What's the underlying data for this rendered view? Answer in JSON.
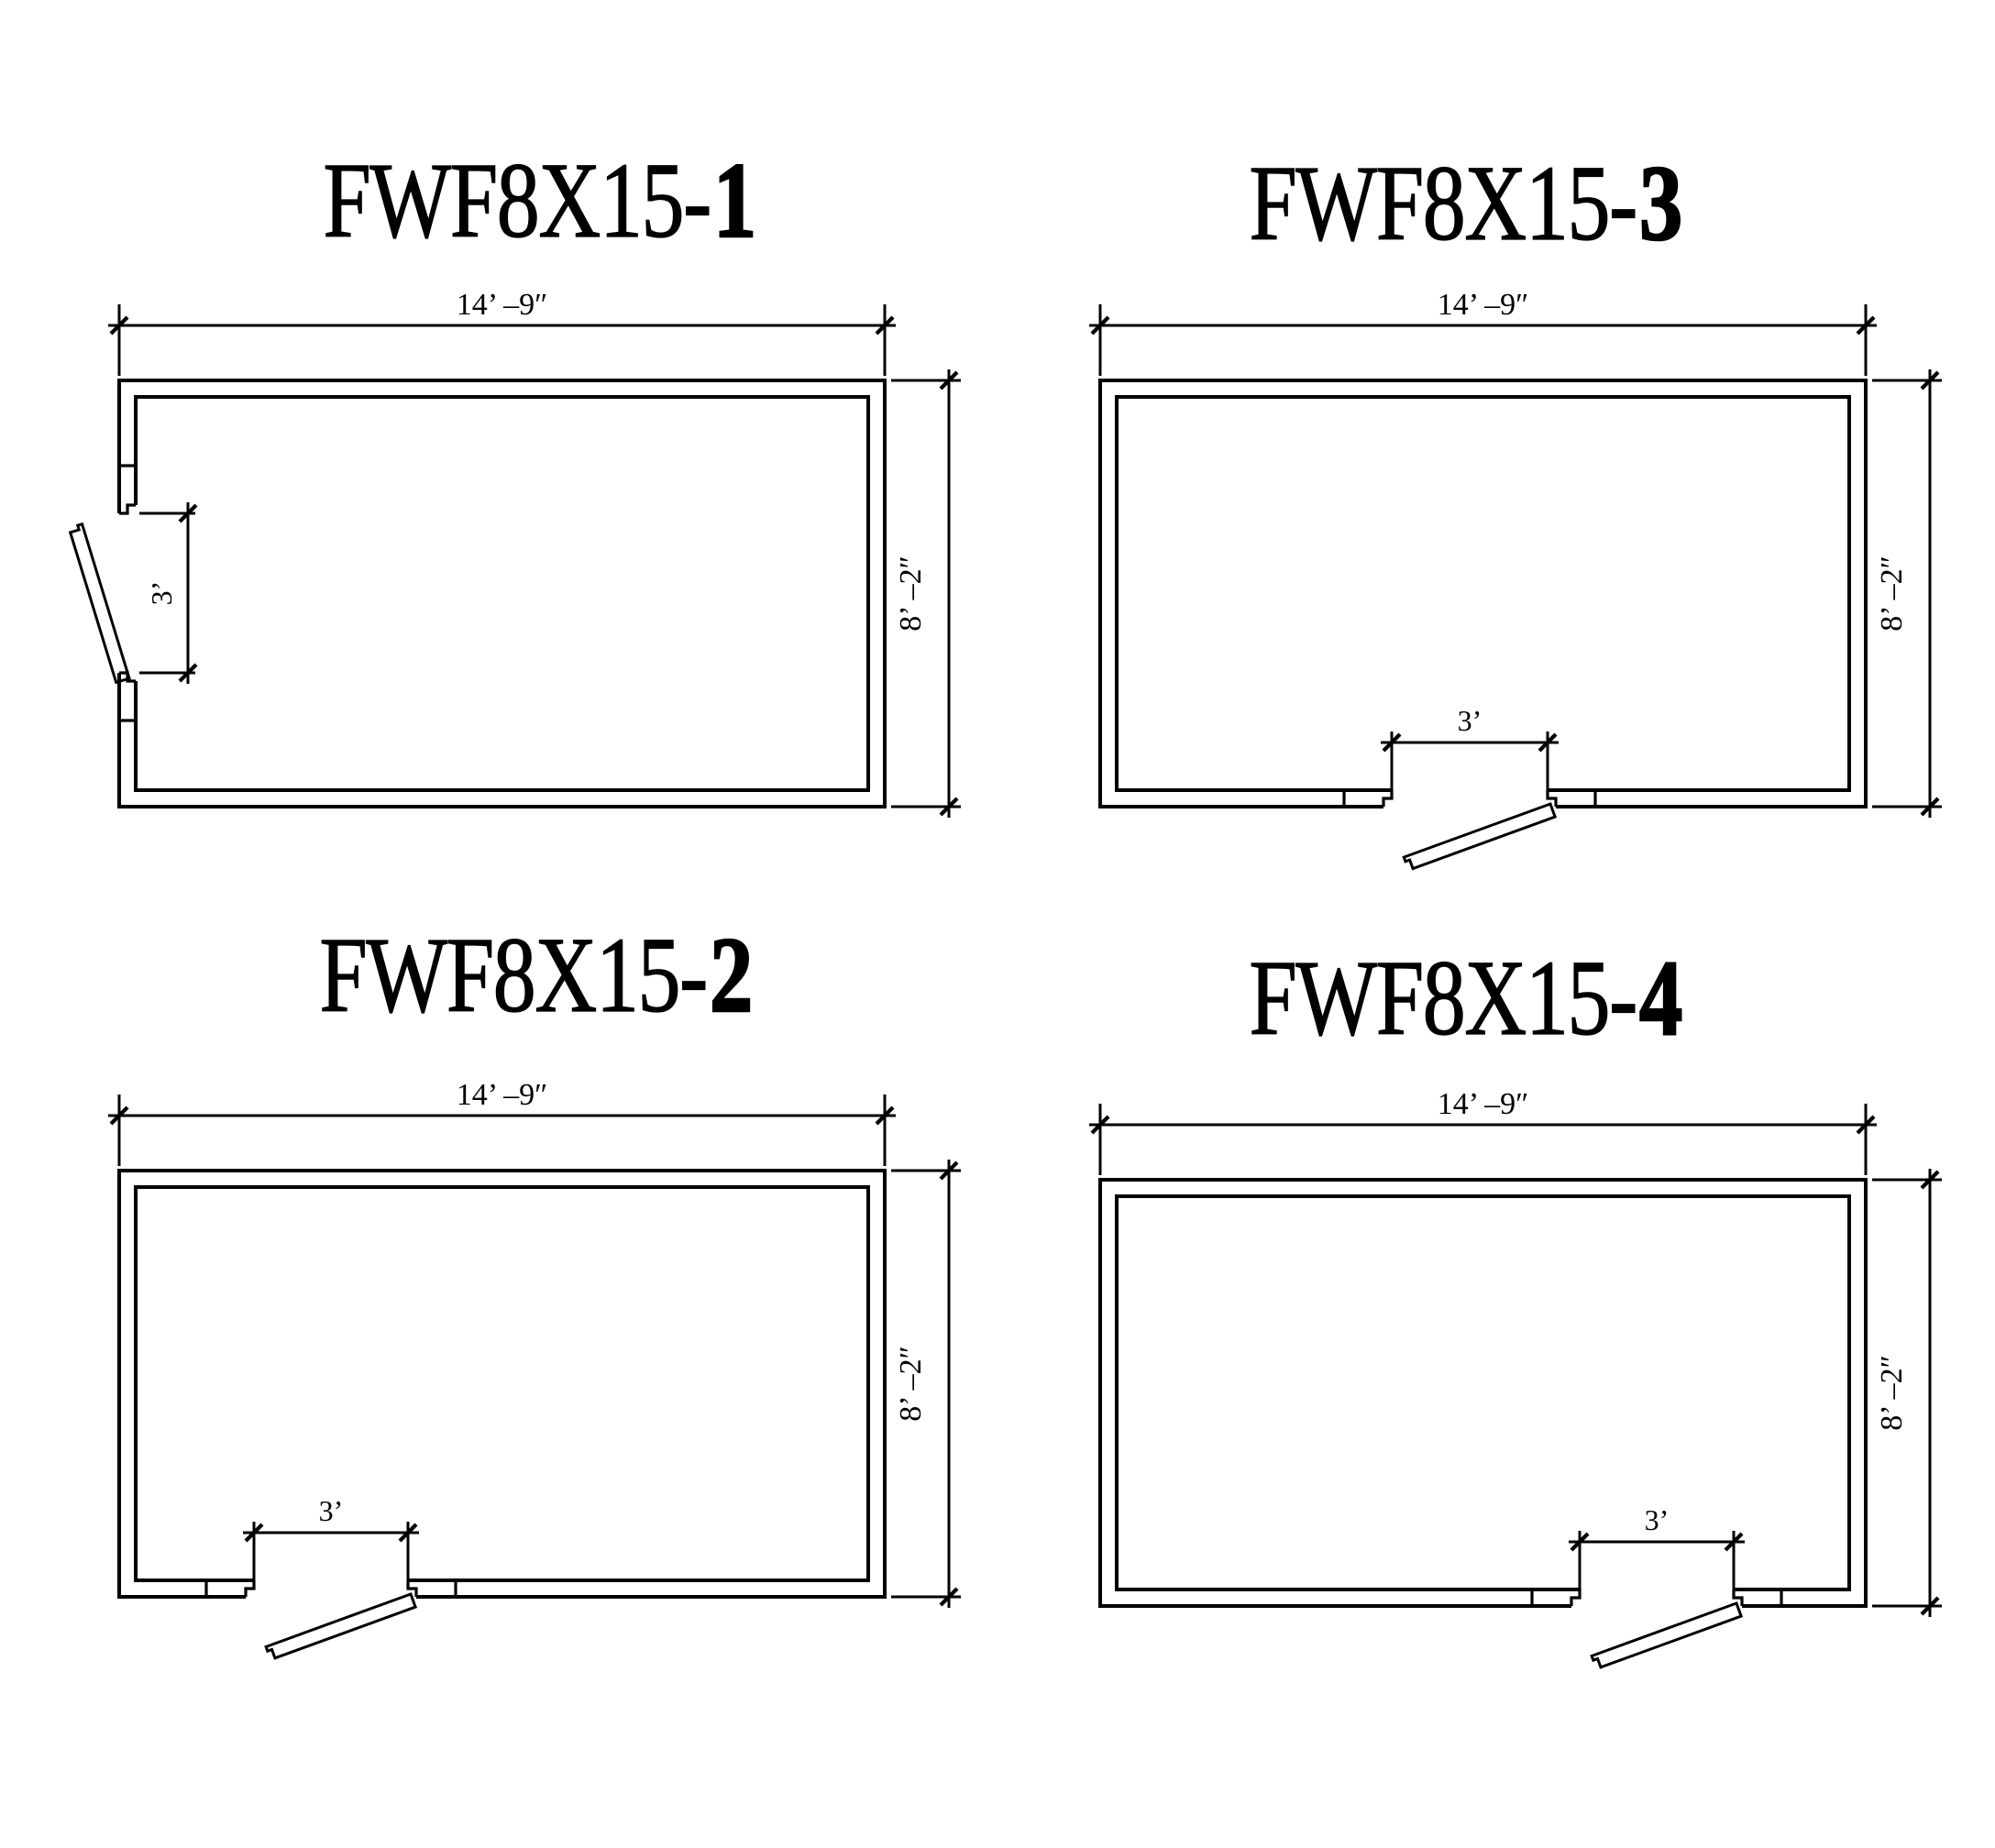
{
  "page": {
    "background": "#ffffff",
    "line_color": "#000000",
    "text_color": "#000000",
    "sheet_type": "cooler floor plan options"
  },
  "plans": [
    {
      "key": "plan-1",
      "title_prefix": "FWF8X15-",
      "title_number": "1",
      "width_label": "14’ –9″",
      "height_label": "8’ –2″",
      "door_width_label": "3’",
      "door": {
        "wall": "left",
        "start": 260,
        "end": 434
      }
    },
    {
      "key": "plan-3",
      "title_prefix": "FWF8X15-",
      "title_number": "3",
      "width_label": "14’ –9″",
      "height_label": "8’ –2″",
      "door_width_label": "3’",
      "door": {
        "wall": "bottom",
        "start": 388,
        "end": 558
      }
    },
    {
      "key": "plan-2",
      "title_prefix": "FWF8X15-",
      "title_number": "2",
      "width_label": "14’ –9″",
      "height_label": "8’ –2″",
      "door_width_label": "3’",
      "door": {
        "wall": "bottom",
        "start": 217,
        "end": 385
      }
    },
    {
      "key": "plan-4",
      "title_prefix": "FWF8X15-",
      "title_number": "4",
      "width_label": "14’ –9″",
      "height_label": "8’ –2″",
      "door_width_label": "3’",
      "door": {
        "wall": "bottom",
        "start": 593,
        "end": 761
      }
    }
  ]
}
